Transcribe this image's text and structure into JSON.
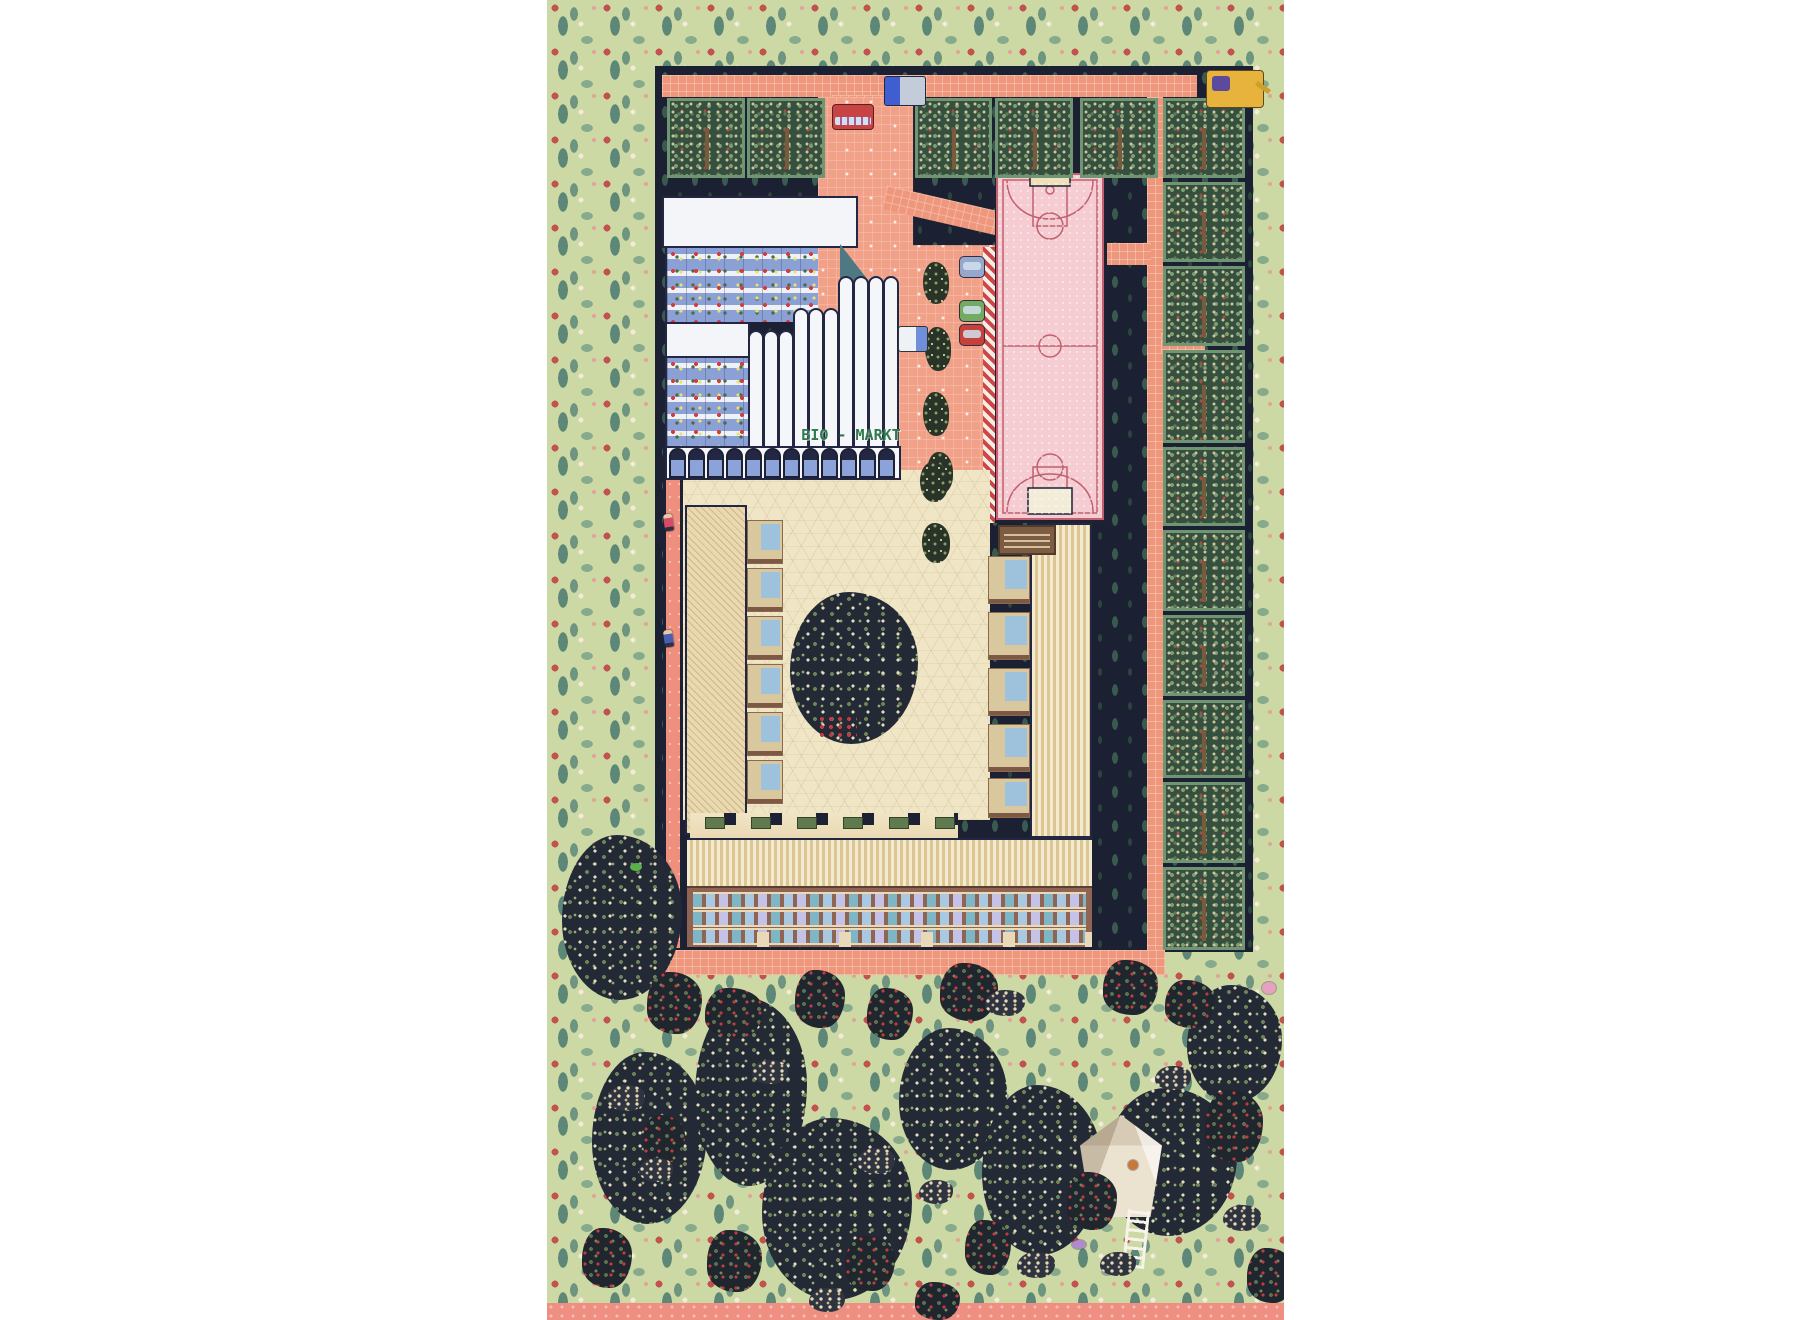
{
  "sign": {
    "bio_markt": "BIO - MARKT"
  },
  "palette": {
    "page_background": "#ffffff",
    "border_pattern_green": "#ccd9a5",
    "pattern_flower_red": "#c2524d",
    "pattern_sprig_teal": "#5d8878",
    "site_navy": "#1b2032",
    "road_salmon": "#ef977c",
    "plaza_salmon": "#f2a189",
    "court_pink": "#f5ccd2",
    "court_line_rose": "#c2606f",
    "orchard_frame_green": "#6f9573",
    "orchard_fill_green": "#35503f",
    "courtyard_beige": "#f0e6c6",
    "supermarket_blue": "#8ba1d6",
    "supermarket_teal_wall": "#4e7982",
    "facade_brown": "#8f6453",
    "roof_stripe_tan": "#dcc794",
    "sign_green": "#2f7a4c"
  },
  "scene": {
    "orchard_cell": [
      {
        "x": 120,
        "y": 98,
        "w": 78,
        "h": 80
      },
      {
        "x": 200,
        "y": 98,
        "w": 78,
        "h": 80
      },
      {
        "x": 368,
        "y": 98,
        "w": 77,
        "h": 80
      },
      {
        "x": 448,
        "y": 98,
        "w": 78,
        "h": 80
      },
      {
        "x": 533,
        "y": 98,
        "w": 78,
        "h": 80
      },
      {
        "x": 616,
        "y": 98,
        "w": 82,
        "h": 80
      },
      {
        "x": 616,
        "y": 182,
        "w": 82,
        "h": 80
      },
      {
        "x": 616,
        "y": 266,
        "w": 82,
        "h": 80
      },
      {
        "x": 616,
        "y": 350,
        "w": 82,
        "h": 93
      },
      {
        "x": 616,
        "y": 447,
        "w": 82,
        "h": 79
      },
      {
        "x": 616,
        "y": 530,
        "w": 82,
        "h": 81
      },
      {
        "x": 616,
        "y": 615,
        "w": 82,
        "h": 81
      },
      {
        "x": 616,
        "y": 700,
        "w": 82,
        "h": 78
      },
      {
        "x": 616,
        "y": 782,
        "w": 82,
        "h": 81
      },
      {
        "x": 616,
        "y": 867,
        "w": 82,
        "h": 83
      }
    ],
    "pipe": [
      {
        "x": 201,
        "y": 330,
        "w": 16,
        "h": 118
      },
      {
        "x": 216,
        "y": 330,
        "w": 16,
        "h": 118
      },
      {
        "x": 231,
        "y": 330,
        "w": 16,
        "h": 118
      },
      {
        "x": 246,
        "y": 308,
        "w": 16,
        "h": 140
      },
      {
        "x": 261,
        "y": 308,
        "w": 16,
        "h": 140
      },
      {
        "x": 276,
        "y": 308,
        "w": 16,
        "h": 140
      },
      {
        "x": 291,
        "y": 276,
        "w": 16,
        "h": 172
      },
      {
        "x": 306,
        "y": 276,
        "w": 16,
        "h": 172
      },
      {
        "x": 321,
        "y": 276,
        "w": 16,
        "h": 172
      },
      {
        "x": 336,
        "y": 276,
        "w": 16,
        "h": 172
      }
    ],
    "arch": [
      {
        "x": 122,
        "y": 448,
        "w": 17,
        "h": 30
      },
      {
        "x": 141,
        "y": 448,
        "w": 17,
        "h": 30
      },
      {
        "x": 160,
        "y": 448,
        "w": 17,
        "h": 30
      },
      {
        "x": 179,
        "y": 448,
        "w": 17,
        "h": 30
      },
      {
        "x": 198,
        "y": 448,
        "w": 17,
        "h": 30
      },
      {
        "x": 217,
        "y": 448,
        "w": 17,
        "h": 30
      },
      {
        "x": 236,
        "y": 448,
        "w": 17,
        "h": 30
      },
      {
        "x": 255,
        "y": 448,
        "w": 17,
        "h": 30
      },
      {
        "x": 274,
        "y": 448,
        "w": 17,
        "h": 30
      },
      {
        "x": 293,
        "y": 448,
        "w": 17,
        "h": 30
      },
      {
        "x": 312,
        "y": 448,
        "w": 17,
        "h": 30
      },
      {
        "x": 331,
        "y": 448,
        "w": 17,
        "h": 30
      }
    ],
    "balcony": [
      {
        "x": 200,
        "y": 520,
        "w": 36,
        "h": 44
      },
      {
        "x": 200,
        "y": 568,
        "w": 36,
        "h": 44
      },
      {
        "x": 200,
        "y": 616,
        "w": 36,
        "h": 44
      },
      {
        "x": 200,
        "y": 664,
        "w": 36,
        "h": 44
      },
      {
        "x": 200,
        "y": 712,
        "w": 36,
        "h": 44
      },
      {
        "x": 200,
        "y": 760,
        "w": 36,
        "h": 44
      }
    ],
    "balcony_r": [
      {
        "x": 441,
        "y": 556,
        "w": 42,
        "h": 48
      },
      {
        "x": 441,
        "y": 612,
        "w": 42,
        "h": 48
      },
      {
        "x": 441,
        "y": 668,
        "w": 42,
        "h": 48
      },
      {
        "x": 441,
        "y": 724,
        "w": 42,
        "h": 48
      },
      {
        "x": 441,
        "y": 778,
        "w": 42,
        "h": 40
      }
    ],
    "planter": [
      {
        "x": 158,
        "y": 817,
        "w": 20,
        "h": 12
      },
      {
        "x": 204,
        "y": 817,
        "w": 20,
        "h": 12
      },
      {
        "x": 250,
        "y": 817,
        "w": 20,
        "h": 12
      },
      {
        "x": 296,
        "y": 817,
        "w": 20,
        "h": 12
      },
      {
        "x": 342,
        "y": 817,
        "w": 20,
        "h": 12
      },
      {
        "x": 388,
        "y": 817,
        "w": 20,
        "h": 12
      }
    ],
    "shrub": [
      {
        "x": 376,
        "y": 262,
        "w": 26,
        "h": 42
      },
      {
        "x": 378,
        "y": 327,
        "w": 26,
        "h": 44
      },
      {
        "x": 376,
        "y": 392,
        "w": 26,
        "h": 44
      },
      {
        "x": 380,
        "y": 452,
        "w": 26,
        "h": 42
      },
      {
        "x": 373,
        "y": 462,
        "w": 28,
        "h": 40
      },
      {
        "x": 375,
        "y": 523,
        "w": 28,
        "h": 40
      }
    ],
    "big_tree": [
      {
        "x": 243,
        "y": 592,
        "w": 128,
        "h": 152
      }
    ],
    "park_tree": [
      {
        "x": 15,
        "y": 835,
        "w": 120,
        "h": 165
      },
      {
        "x": 45,
        "y": 1052,
        "w": 115,
        "h": 172
      },
      {
        "x": 148,
        "y": 998,
        "w": 112,
        "h": 188
      },
      {
        "x": 215,
        "y": 1118,
        "w": 150,
        "h": 182
      },
      {
        "x": 352,
        "y": 1028,
        "w": 108,
        "h": 142
      },
      {
        "x": 435,
        "y": 1085,
        "w": 120,
        "h": 170
      },
      {
        "x": 558,
        "y": 1088,
        "w": 132,
        "h": 148
      },
      {
        "x": 640,
        "y": 985,
        "w": 95,
        "h": 118
      }
    ],
    "treehouse": [
      {
        "x": 533,
        "y": 1115,
        "w": 82,
        "h": 102
      }
    ],
    "ladder": [
      {
        "x": 578,
        "y": 1210,
        "w": 22,
        "h": 58,
        "r": 6
      }
    ],
    "park_bush": [
      {
        "x": 100,
        "y": 972,
        "w": 55,
        "h": 62
      },
      {
        "x": 158,
        "y": 988,
        "w": 58,
        "h": 50
      },
      {
        "x": 248,
        "y": 970,
        "w": 50,
        "h": 58
      },
      {
        "x": 320,
        "y": 988,
        "w": 46,
        "h": 52
      },
      {
        "x": 393,
        "y": 963,
        "w": 58,
        "h": 58
      },
      {
        "x": 556,
        "y": 960,
        "w": 55,
        "h": 55
      },
      {
        "x": 618,
        "y": 980,
        "w": 50,
        "h": 48
      },
      {
        "x": 35,
        "y": 1228,
        "w": 50,
        "h": 60
      },
      {
        "x": 160,
        "y": 1230,
        "w": 55,
        "h": 62
      },
      {
        "x": 298,
        "y": 1236,
        "w": 50,
        "h": 55
      },
      {
        "x": 418,
        "y": 1220,
        "w": 46,
        "h": 55
      },
      {
        "x": 520,
        "y": 1172,
        "w": 50,
        "h": 58
      },
      {
        "x": 658,
        "y": 1090,
        "w": 58,
        "h": 72
      },
      {
        "x": 700,
        "y": 1248,
        "w": 48,
        "h": 55
      },
      {
        "x": 368,
        "y": 1282,
        "w": 45,
        "h": 38
      },
      {
        "x": 96,
        "y": 1115,
        "w": 42,
        "h": 48
      }
    ],
    "flower_cluster": [
      {
        "x": 60,
        "y": 1085,
        "w": 38,
        "h": 26
      },
      {
        "x": 205,
        "y": 1060,
        "w": 36,
        "h": 24
      },
      {
        "x": 310,
        "y": 1148,
        "w": 38,
        "h": 26
      },
      {
        "x": 372,
        "y": 1180,
        "w": 34,
        "h": 24
      },
      {
        "x": 470,
        "y": 1252,
        "w": 38,
        "h": 26
      },
      {
        "x": 553,
        "y": 1252,
        "w": 36,
        "h": 24
      },
      {
        "x": 608,
        "y": 1066,
        "w": 36,
        "h": 24
      },
      {
        "x": 676,
        "y": 1205,
        "w": 38,
        "h": 26
      },
      {
        "x": 92,
        "y": 1158,
        "w": 34,
        "h": 24
      },
      {
        "x": 262,
        "y": 1288,
        "w": 36,
        "h": 24
      },
      {
        "x": 438,
        "y": 990,
        "w": 40,
        "h": 26
      }
    ],
    "car": [
      {
        "x": 412,
        "y": 256,
        "w": 26,
        "h": 22,
        "bg": "#97a6cc"
      },
      {
        "x": 412,
        "y": 300,
        "w": 26,
        "h": 22,
        "bg": "#74aa62"
      },
      {
        "x": 412,
        "y": 324,
        "w": 26,
        "h": 22,
        "bg": "#c8403c"
      }
    ],
    "bus": [
      {
        "x": 285,
        "y": 104,
        "w": 42,
        "h": 26
      }
    ],
    "truck": [
      {
        "x": 337,
        "y": 76,
        "w": 42,
        "h": 30
      }
    ],
    "delivery": [
      {
        "x": 351,
        "y": 326,
        "w": 30,
        "h": 26
      }
    ],
    "digger": [
      {
        "x": 659,
        "y": 70,
        "w": 58,
        "h": 38
      }
    ],
    "person_courtyard": [
      {
        "x": 153,
        "y": 497,
        "c": "#b5433c"
      },
      {
        "x": 198,
        "y": 480,
        "c": "#3f6d8e"
      },
      {
        "x": 221,
        "y": 470,
        "c": "#d8739c"
      },
      {
        "x": 273,
        "y": 470,
        "c": "#c04545"
      },
      {
        "x": 291,
        "y": 478,
        "c": "#3c7a4f"
      },
      {
        "x": 313,
        "y": 467,
        "c": "#6b4fa0"
      },
      {
        "x": 333,
        "y": 492,
        "c": "#cc4c6a"
      },
      {
        "x": 246,
        "y": 520,
        "c": "#8a8f3c"
      },
      {
        "x": 265,
        "y": 526,
        "c": "#4666a8"
      },
      {
        "x": 286,
        "y": 519,
        "c": "#c04545"
      },
      {
        "x": 304,
        "y": 512,
        "c": "#2f8a78"
      },
      {
        "x": 213,
        "y": 540,
        "c": "#7a4ca0"
      },
      {
        "x": 235,
        "y": 552,
        "c": "#2f6bb0"
      },
      {
        "x": 257,
        "y": 548,
        "c": "#3f8a58"
      },
      {
        "x": 279,
        "y": 556,
        "c": "#d8a03c"
      },
      {
        "x": 299,
        "y": 560,
        "c": "#c04545"
      },
      {
        "x": 317,
        "y": 551,
        "c": "#4a5fb0"
      },
      {
        "x": 337,
        "y": 540,
        "c": "#52b0a0"
      },
      {
        "x": 261,
        "y": 585,
        "c": "#c85a88"
      },
      {
        "x": 288,
        "y": 590,
        "c": "#4a8a3f"
      },
      {
        "x": 323,
        "y": 588,
        "c": "#3f4f9a"
      },
      {
        "x": 353,
        "y": 575,
        "c": "#c07840"
      },
      {
        "x": 373,
        "y": 520,
        "c": "#3c7a4f"
      },
      {
        "x": 391,
        "y": 492,
        "c": "#b8ccd8"
      },
      {
        "x": 403,
        "y": 465,
        "c": "#7a55b8"
      },
      {
        "x": 356,
        "y": 618,
        "c": "#88b83c"
      },
      {
        "x": 379,
        "y": 640,
        "c": "#4a5f9a"
      },
      {
        "x": 291,
        "y": 700,
        "c": "#3c8a4f"
      },
      {
        "x": 333,
        "y": 738,
        "c": "#2f7a68"
      },
      {
        "x": 376,
        "y": 785,
        "c": "#8a8a92"
      },
      {
        "x": 391,
        "y": 792,
        "c": "#8a8a92"
      },
      {
        "x": 321,
        "y": 800,
        "c": "#c05575"
      },
      {
        "x": 263,
        "y": 806,
        "c": "#4a7ab0"
      }
    ],
    "person_plaza": [
      {
        "x": 358,
        "y": 303,
        "c": "#6b7a4a"
      },
      {
        "x": 408,
        "y": 388,
        "c": "#4a5f9a"
      },
      {
        "x": 328,
        "y": 445,
        "c": "#c05575"
      },
      {
        "x": 393,
        "y": 455,
        "c": "#cf8a3c"
      },
      {
        "x": 381,
        "y": 212,
        "c": "#c06030"
      },
      {
        "x": 578,
        "y": 245,
        "c": "#c06838"
      }
    ],
    "person_path": [
      {
        "x": 603,
        "y": 248,
        "c": "#c06a3c"
      },
      {
        "x": 607,
        "y": 305,
        "c": "#8a4fb0"
      },
      {
        "x": 627,
        "y": 336,
        "c": "#b0903c"
      },
      {
        "x": 605,
        "y": 622,
        "c": "#3f6d8e"
      },
      {
        "x": 603,
        "y": 930,
        "c": "#4a8a58"
      }
    ],
    "person_sidewalk": [
      {
        "x": 125,
        "y": 935,
        "c": "#8a3c50"
      },
      {
        "x": 203,
        "y": 952,
        "c": "#3c5a8e"
      },
      {
        "x": 293,
        "y": 955,
        "c": "#c05a3c"
      },
      {
        "x": 408,
        "y": 950,
        "c": "#4a7a3f"
      },
      {
        "x": 461,
        "y": 953,
        "c": "#7a8a3c"
      },
      {
        "x": 515,
        "y": 955,
        "c": "#e8e2d4"
      }
    ],
    "person_court": [
      {
        "x": 516,
        "y": 424,
        "c": "#3c8a4f"
      },
      {
        "x": 535,
        "y": 430,
        "c": "#4a4fb0"
      }
    ],
    "climber": [
      {
        "x": 117,
        "y": 514,
        "c": "#d84a6a"
      },
      {
        "x": 117,
        "y": 630,
        "c": "#4a5fb0"
      }
    ],
    "person_park": [
      {
        "x": 98,
        "y": 1288,
        "c": "#7a4ca0"
      },
      {
        "x": 335,
        "y": 1286,
        "c": "#8a5fb8"
      },
      {
        "x": 333,
        "y": 995,
        "c": "#e8e4f0"
      },
      {
        "x": 648,
        "y": 1022,
        "c": "#9aa0ac"
      },
      {
        "x": 558,
        "y": 1063,
        "c": "#c0443c"
      },
      {
        "x": 700,
        "y": 1286,
        "c": "#3f7a58"
      }
    ],
    "critter": [
      {
        "x": 581,
        "y": 1160,
        "w": 10,
        "h": 10,
        "bg": "#c87838"
      },
      {
        "x": 525,
        "y": 1240,
        "w": 14,
        "h": 9,
        "bg": "#b08ad0"
      },
      {
        "x": 83,
        "y": 863,
        "w": 12,
        "h": 8,
        "bg": "#58b048"
      },
      {
        "x": 715,
        "y": 982,
        "w": 14,
        "h": 12,
        "bg": "#e8a0c0"
      }
    ]
  }
}
